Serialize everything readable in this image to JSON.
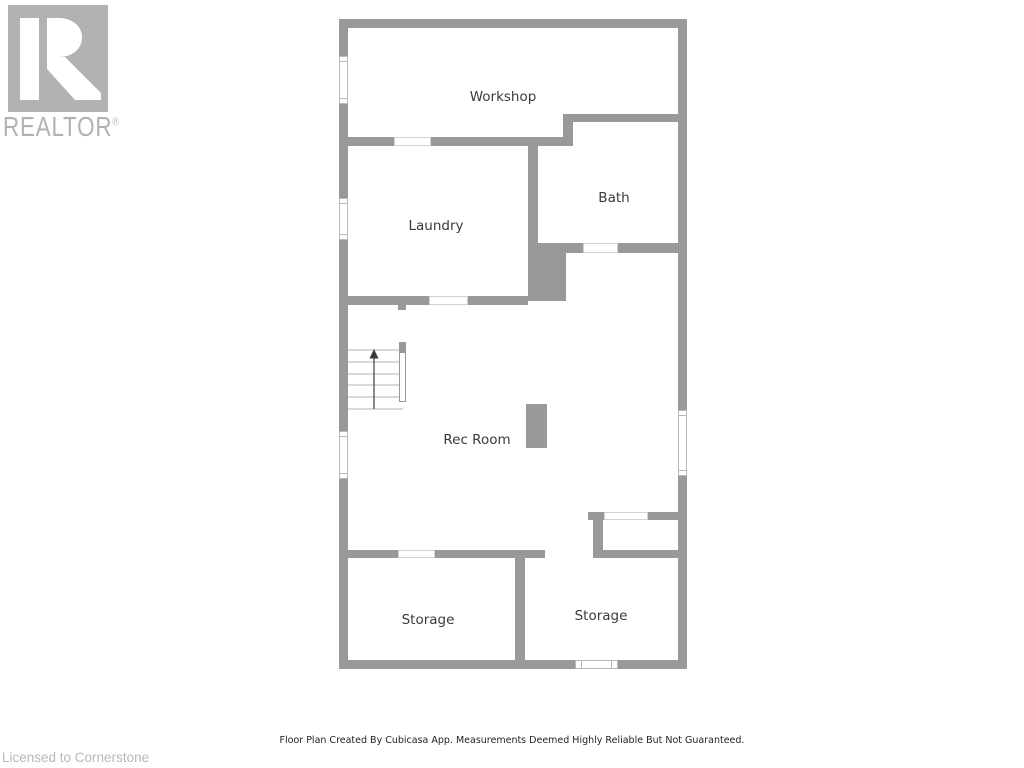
{
  "branding": {
    "logo_text": "REALTOR",
    "registered_mark": "®",
    "licensed_text": "Licensed to Cornerstone"
  },
  "floor_plan": {
    "rooms": [
      {
        "label": "Workshop"
      },
      {
        "label": "Bath"
      },
      {
        "label": "Laundry"
      },
      {
        "label": "Rec Room"
      },
      {
        "label": "Storage"
      },
      {
        "label": "Storage"
      }
    ],
    "features": [
      "stairs-up",
      "chase-column",
      "rec-room-column",
      "5-windows",
      "door-openings"
    ],
    "footer_note": "Floor Plan Created By Cubicasa App. Measurements Deemed Highly Reliable But Not Guaranteed."
  },
  "colors": {
    "wall": "#999999",
    "logo_gray": "#b2b2b2",
    "room_label": "#3a3a3a",
    "footer_text": "#1f1f1f",
    "licensed_text": "#b5b9bc",
    "window_frame": "#b9b9b9",
    "opening_casing": "#d2d2d2"
  }
}
